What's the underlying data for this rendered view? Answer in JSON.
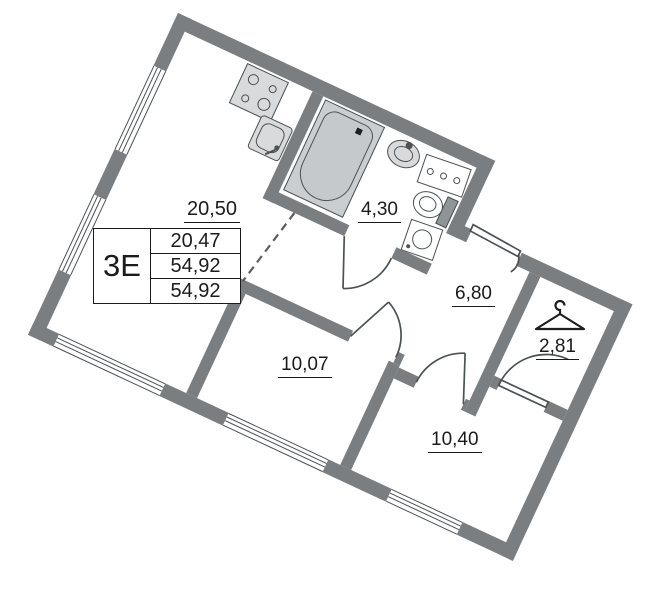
{
  "plan": {
    "unit": {
      "type_label": "3Е",
      "area_rows": [
        "20,47",
        "54,92",
        "54,92"
      ]
    },
    "rooms": [
      {
        "id": "kitchen-living",
        "area": "20,50"
      },
      {
        "id": "bathroom",
        "area": "4,30"
      },
      {
        "id": "hallway",
        "area": "6,80"
      },
      {
        "id": "wardrobe",
        "area": "2,81"
      },
      {
        "id": "room-1",
        "area": "10,07"
      },
      {
        "id": "room-2",
        "area": "10,40"
      }
    ],
    "icons": [
      "stove-icon",
      "kitchen-sink-icon",
      "bathtub-icon",
      "washbasin-icon",
      "socket-panel-icon",
      "toilet-icon",
      "washing-machine-icon",
      "hanger-icon",
      "door-arc",
      "window-glazing"
    ],
    "colors": {
      "wall": "#7a7e81",
      "line": "#4c5153",
      "text": "#1b1b1b"
    }
  }
}
